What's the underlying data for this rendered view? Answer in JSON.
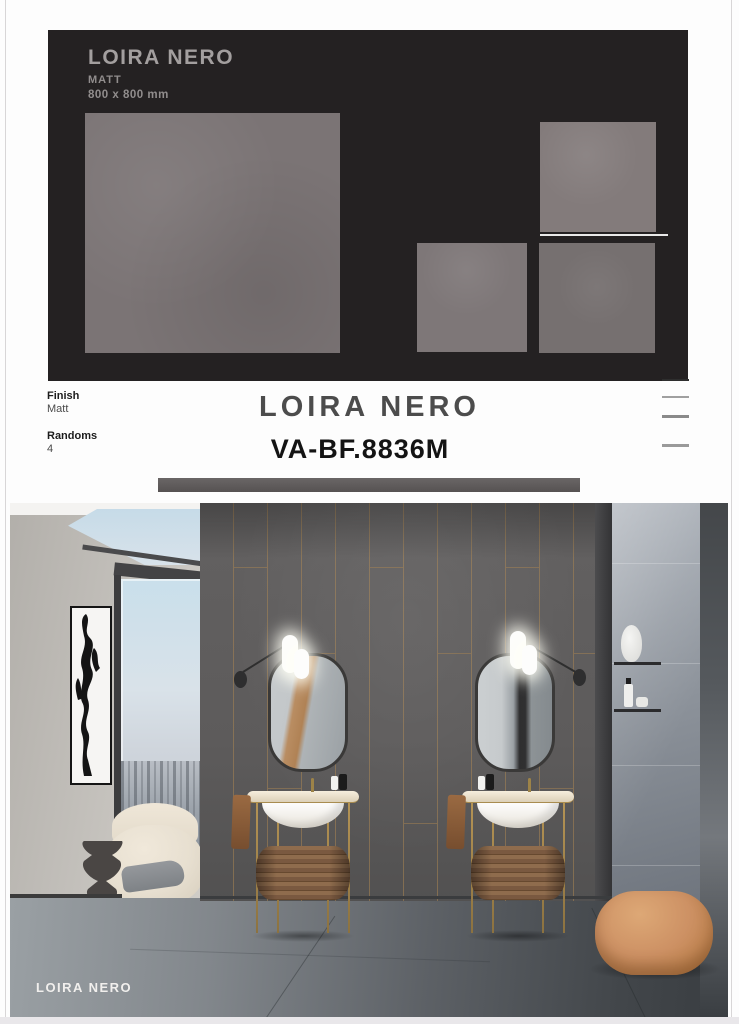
{
  "board": {
    "title": "LOIRA NERO",
    "finish": "MATT",
    "size": "800 x 800 mm"
  },
  "specs": {
    "finish_label": "Finish",
    "finish_value": "Matt",
    "randoms_label": "Randoms",
    "randoms_value": "4"
  },
  "product": {
    "name": "LOIRA NERO",
    "code": "VA-BF.8836M"
  },
  "photo": {
    "caption": "LOIRA NERO"
  },
  "colors": {
    "board_bg": "#242122",
    "tile_gray": "#7b7475",
    "brass_accent": "#a88452",
    "dark_wall": "#5f5d5d",
    "pouf_tan": "#cd9164"
  }
}
